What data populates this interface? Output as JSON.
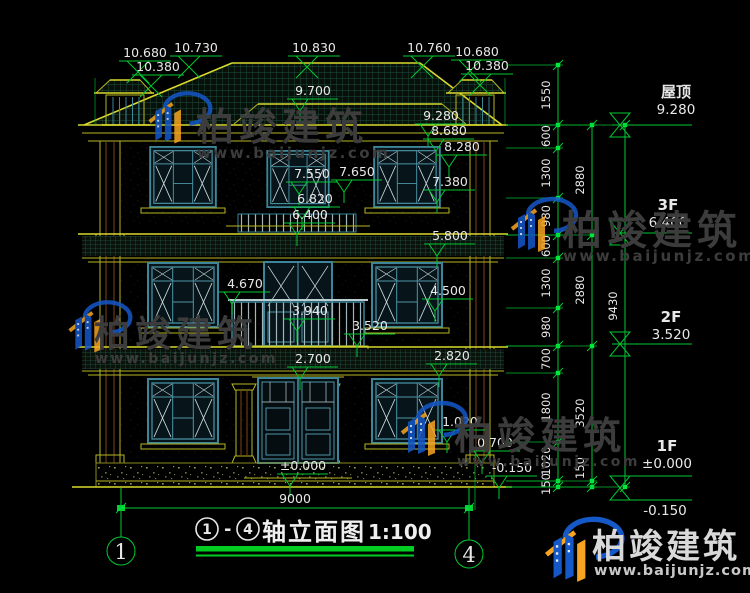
{
  "colors": {
    "background": "#000000",
    "cad_line_yellow": "#b6b622",
    "cad_line_green": "#00c832",
    "window_teal": "#3d8598",
    "text_white": "#e8e8e8",
    "brand_blue": "#1558c8",
    "brand_orange": "#f7a520",
    "title_underline_green": "#00cc22"
  },
  "watermark": {
    "brand": "柏竣建筑",
    "url": "www.baijunjz.com"
  },
  "logo_block": {
    "brand": "柏竣建筑",
    "url": "www.baijunjz.com"
  },
  "title_block": {
    "axis_from": "1",
    "axis_to": "4",
    "dash": "-",
    "label": "轴立面图",
    "scale": "1:100"
  },
  "axis_bubbles": {
    "left": "1",
    "right": "4"
  },
  "bottom_dim": {
    "value": "9000"
  },
  "annotations": {
    "top_dims": [
      {
        "t": "10.680",
        "x": 145,
        "y": 57
      },
      {
        "t": "10.380",
        "x": 158,
        "y": 71
      },
      {
        "t": "10.730",
        "x": 196,
        "y": 52
      },
      {
        "t": "10.830",
        "x": 314,
        "y": 52
      },
      {
        "t": "10.760",
        "x": 429,
        "y": 52
      },
      {
        "t": "10.680",
        "x": 477,
        "y": 56
      },
      {
        "t": "10.380",
        "x": 487,
        "y": 70
      }
    ],
    "levels": [
      {
        "t": "9.700",
        "x": 313,
        "y": 95
      },
      {
        "t": "9.280",
        "x": 441,
        "y": 120
      },
      {
        "t": "8.680",
        "x": 449,
        "y": 135
      },
      {
        "t": "8.280",
        "x": 462,
        "y": 151
      },
      {
        "t": "7.550",
        "x": 312,
        "y": 178
      },
      {
        "t": "7.650",
        "x": 357,
        "y": 176
      },
      {
        "t": "7.380",
        "x": 450,
        "y": 186
      },
      {
        "t": "6.820",
        "x": 315,
        "y": 203
      },
      {
        "t": "6.400",
        "x": 310,
        "y": 219
      },
      {
        "t": "5.800",
        "x": 450,
        "y": 240
      },
      {
        "t": "4.670",
        "x": 245,
        "y": 288
      },
      {
        "t": "4.500",
        "x": 448,
        "y": 295
      },
      {
        "t": "3.940",
        "x": 310,
        "y": 315
      },
      {
        "t": "3.520",
        "x": 370,
        "y": 330
      },
      {
        "t": "2.700",
        "x": 313,
        "y": 363
      },
      {
        "t": "2.820",
        "x": 452,
        "y": 360
      },
      {
        "t": "1.020",
        "x": 460,
        "y": 426
      },
      {
        "t": "0.700",
        "x": 495,
        "y": 447
      },
      {
        "t": "±0.000",
        "x": 303,
        "y": 470
      },
      {
        "t": "-0.150",
        "x": 512,
        "y": 472
      }
    ],
    "chains": [
      {
        "x": 558,
        "ticks": [
          65,
          125,
          148,
          198,
          235,
          258,
          308,
          346,
          373,
          442,
          481,
          487
        ],
        "labels": [
          {
            "t": "1550",
            "y": 95
          },
          {
            "t": "600",
            "y": 136
          },
          {
            "t": "1300",
            "y": 173
          },
          {
            "t": "980",
            "y": 216
          },
          {
            "t": "600",
            "y": 246
          },
          {
            "t": "1300",
            "y": 283
          },
          {
            "t": "980",
            "y": 327
          },
          {
            "t": "700",
            "y": 359
          },
          {
            "t": "1800",
            "y": 407
          },
          {
            "t": "1020",
            "y": 461
          },
          {
            "t": "150",
            "y": 484
          }
        ]
      },
      {
        "x": 592,
        "ticks": [
          125,
          235,
          346,
          481,
          487
        ],
        "labels": [
          {
            "t": "2880",
            "y": 180
          },
          {
            "t": "2880",
            "y": 290
          },
          {
            "t": "3520",
            "y": 413
          },
          {
            "t": "150",
            "y": 468
          }
        ]
      },
      {
        "x": 625,
        "ticks": [
          125,
          487
        ],
        "labels": [
          {
            "t": "9430",
            "y": 306
          }
        ]
      }
    ],
    "flags": [
      {
        "floor": "屋顶",
        "value": "9.280",
        "x": 676,
        "fy": 97,
        "vy": 114,
        "ly": 125,
        "hg": 12,
        "hgy": 125
      },
      {
        "floor": "3F",
        "value": "6.400",
        "x": 668,
        "fy": 210,
        "vy": 227,
        "ly": 233,
        "hg": 12,
        "hgy": 233
      },
      {
        "floor": "2F",
        "value": "3.520",
        "x": 671,
        "fy": 322,
        "vy": 339,
        "ly": 344,
        "hg": 12,
        "hgy": 344
      },
      {
        "floor": "1F",
        "value": "±0.000",
        "x": 667,
        "fy": 451,
        "vy": 468,
        "ly": 476,
        "hg": 12,
        "hgy": 488
      },
      {
        "floor": "",
        "value": "-0.150",
        "x": 665,
        "fy": 0,
        "vy": 515,
        "ly": 500,
        "hg": 0,
        "hgy": 0
      }
    ]
  }
}
